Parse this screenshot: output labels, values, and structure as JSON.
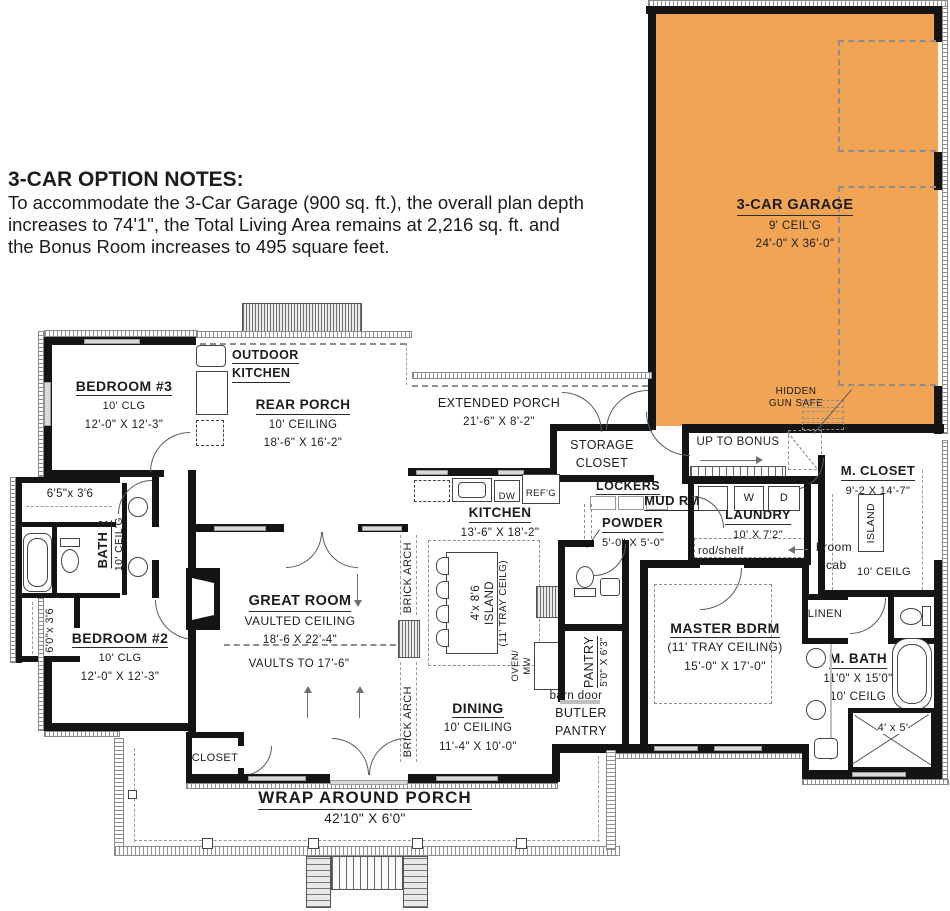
{
  "notes": {
    "title": "3-CAR OPTION NOTES:",
    "line1": "To accommodate the 3-Car Garage (900 sq. ft.), the overall plan depth",
    "line2": "increases to 74'1\", the Total Living Area  remains at 2,216 sq. ft. and",
    "line3": "the Bonus Room increases to 495 square feet."
  },
  "colors": {
    "garage_fill": "#F2A455"
  },
  "garage": {
    "name": "3-CAR GARAGE",
    "ceiling": "9' CEIL'G",
    "dims": "24'-0\" X 36'-0\"",
    "hidden_safe_line1": "HIDDEN",
    "hidden_safe_line2": "GUN SAFE"
  },
  "stairs": {
    "label": "UP TO BONUS"
  },
  "m_closet": {
    "name": "M. CLOSET",
    "dims": "9'-2 X 14'-7\"",
    "island": "ISLAND",
    "ceiling": "10' CEILG"
  },
  "laundry": {
    "name": "LAUNDRY",
    "dims": "10' X 7'2\"",
    "washer": "W",
    "dryer": "D",
    "rod_shelf": "rod/shelf",
    "broom_line1": "broom",
    "broom_line2": "cab"
  },
  "mud": {
    "lockers": "LOCKERS",
    "name": "MUD RM"
  },
  "storage_closet": {
    "line1": "STORAGE",
    "line2": "CLOSET"
  },
  "extended_porch": {
    "name": "EXTENDED PORCH",
    "dims": "21'-6\" X 8'-2\""
  },
  "outdoor_kitchen": {
    "line1": "OUTDOOR",
    "line2": "KITCHEN"
  },
  "rear_porch": {
    "name": "REAR PORCH",
    "ceiling": "10' CEILING",
    "dims": "18'-6\" X 16'-2\""
  },
  "bedroom3": {
    "name": "BEDROOM #3",
    "ceiling": "10' CLG",
    "dims": "12'-0\" X 12'-3\""
  },
  "bath2": {
    "name": "BATH 2",
    "ceiling": "10' CEIL'G"
  },
  "closets": {
    "c65": "6'5\"x 3'6",
    "c60": "6'0\"x 3'6",
    "great_room": "CLOSET"
  },
  "bedroom2": {
    "name": "BEDROOM #2",
    "ceiling": "10' CLG",
    "dims": "12'-0\" X 12'-3\""
  },
  "great_room": {
    "name": "GREAT ROOM",
    "ceiling": "VAULTED CEILING",
    "dims": "18'-6 X 22'-4\"",
    "vaults": "VAULTS TO 17'-6\""
  },
  "brick_arch": "BRICK ARCH",
  "kitchen": {
    "name": "KITCHEN",
    "dims": "13'-6\" X 18'-2\"",
    "dw": "DW",
    "refg": "REF'G",
    "island_size": "4'x 8'6",
    "island_word": "ISLAND",
    "island_ceiling": "(11' TRAY CEILG)",
    "oven_line1": "OVEN/",
    "oven_line2": "MW"
  },
  "powder": {
    "name": "POWDER",
    "dims": "5'-0\" X 5'-0\""
  },
  "pantry": {
    "name": "PANTRY",
    "dims": "5'0\" X 6'3\""
  },
  "butler": {
    "barn_door": "barn door",
    "line1": "BUTLER",
    "line2": "PANTRY"
  },
  "dining": {
    "name": "DINING",
    "ceiling": "10' CEILING",
    "dims": "11'-4\" X 10'-0\""
  },
  "master": {
    "name": "MASTER BDRM",
    "ceiling": "(11' TRAY CEILING)",
    "dims": "15'-0\" X 17'-0\""
  },
  "linen": "LINEN",
  "m_bath": {
    "name": "M. BATH",
    "dims": "11'0\" X 15'0\"",
    "ceiling": "10' CEILG",
    "shower": "4' x 5'"
  },
  "wrap_porch": {
    "name": "WRAP AROUND PORCH",
    "dims": "42'10\" X 6'0\""
  }
}
